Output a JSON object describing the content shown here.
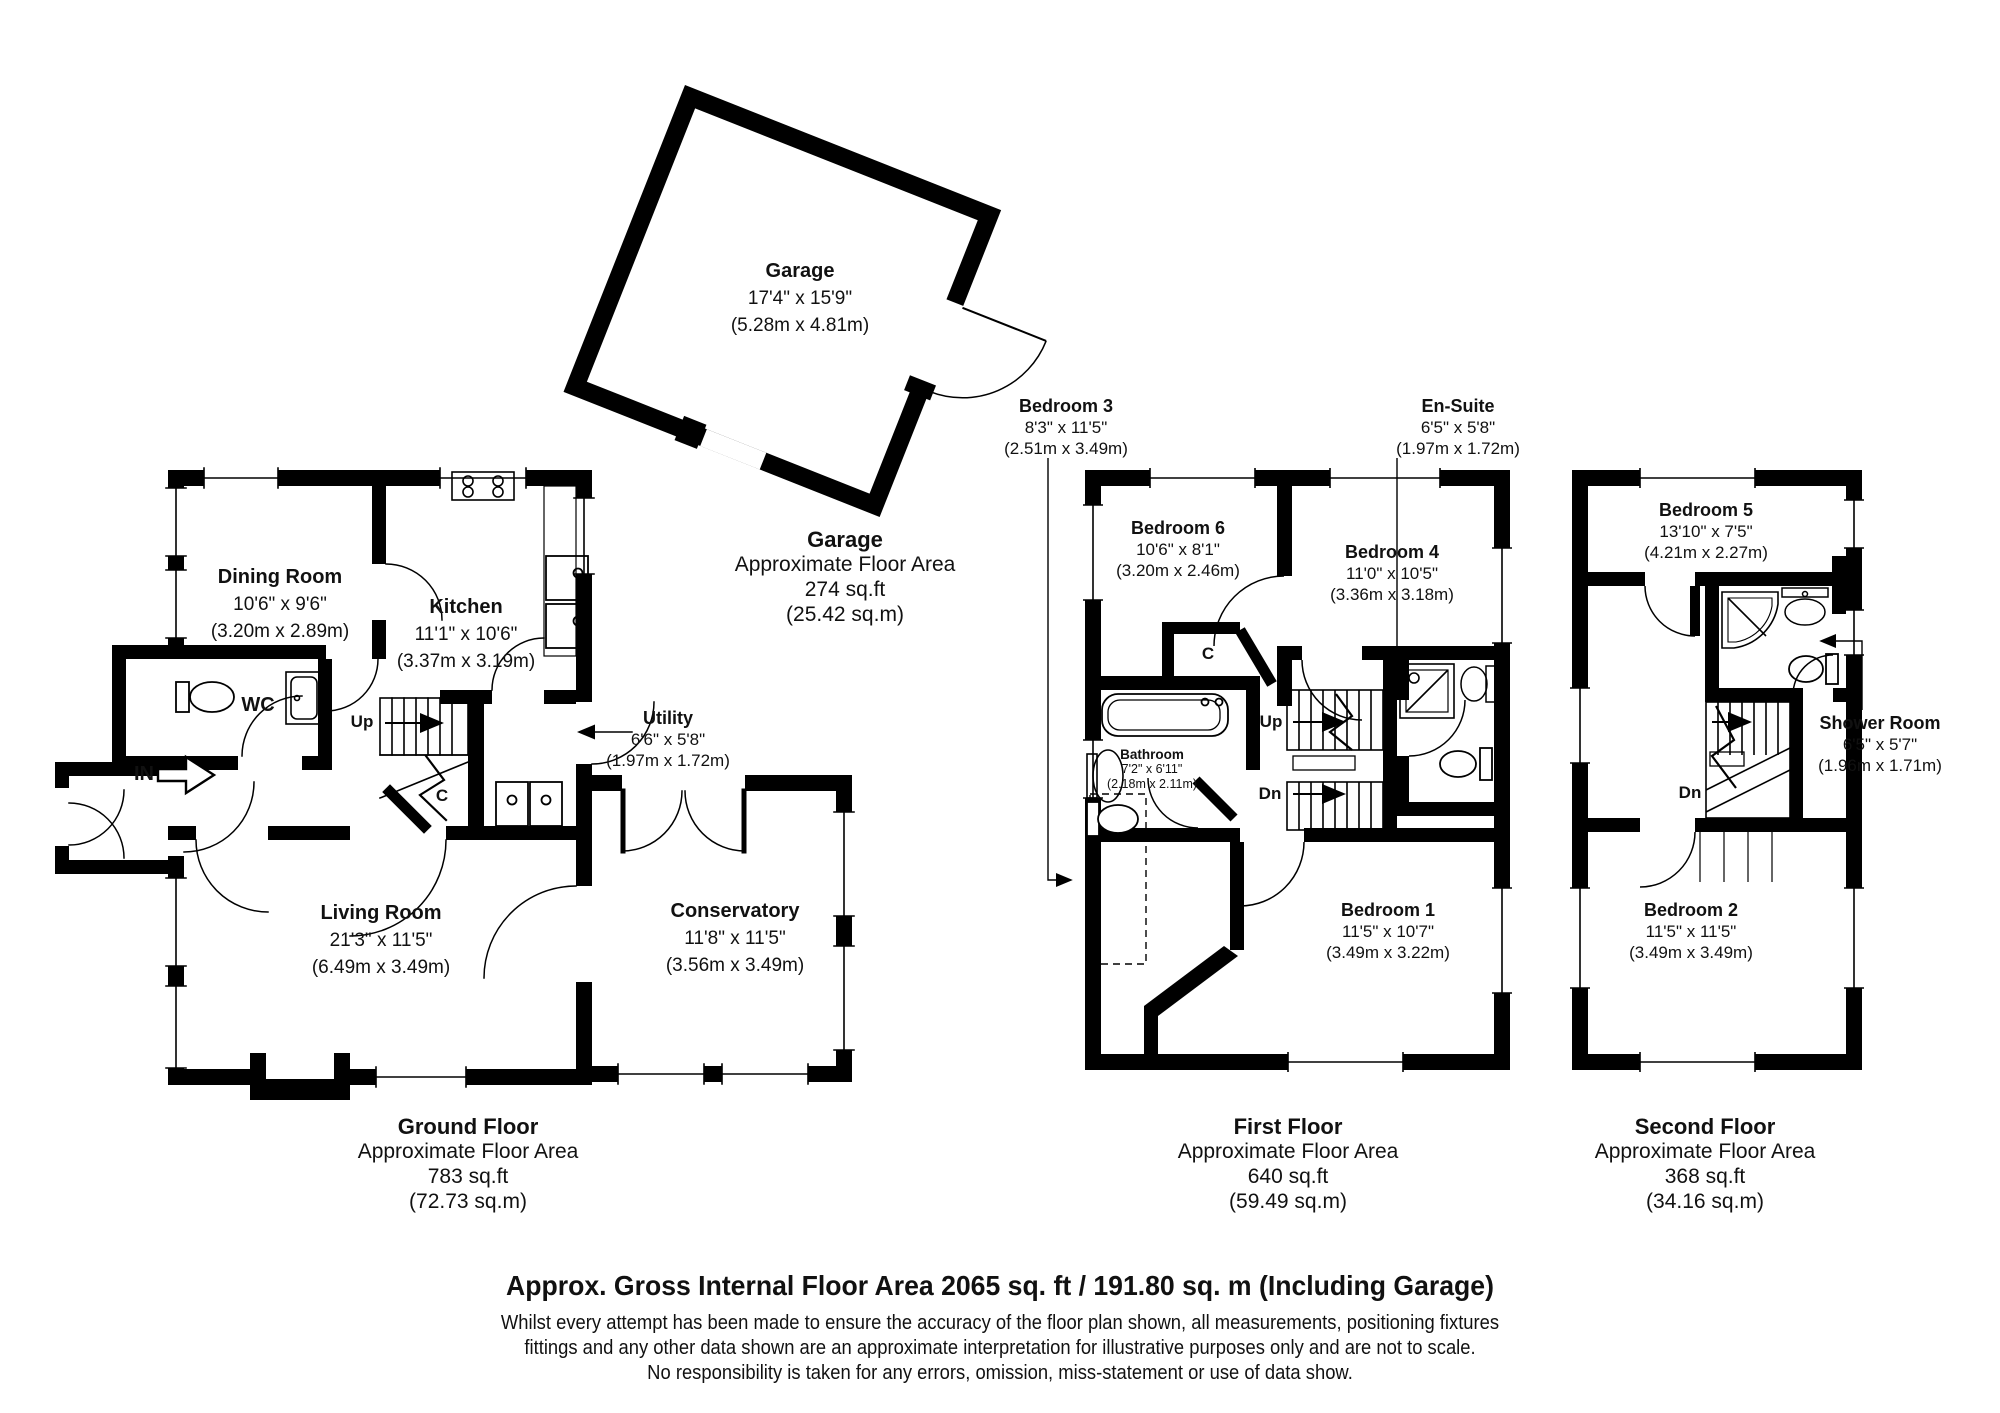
{
  "garage": {
    "room_label": {
      "name": "Garage",
      "dims_ft": "17'4\" x 15'9\"",
      "dims_m": "(5.28m x 4.81m)"
    },
    "summary": {
      "title": "Garage",
      "subtitle": "Approximate Floor Area",
      "area_ft": "274 sq.ft",
      "area_m": "(25.42 sq.m)"
    }
  },
  "ground_floor": {
    "rooms": {
      "dining_room": {
        "name": "Dining Room",
        "dims_ft": "10'6\" x 9'6\"",
        "dims_m": "(3.20m x 2.89m)"
      },
      "kitchen": {
        "name": "Kitchen",
        "dims_ft": "11'1\" x 10'6\"",
        "dims_m": "(3.37m x 3.19m)"
      },
      "utility": {
        "name": "Utility",
        "dims_ft": "6'6\" x 5'8\"",
        "dims_m": "(1.97m x 1.72m)"
      },
      "living_room": {
        "name": "Living Room",
        "dims_ft": "21'3\" x 11'5\"",
        "dims_m": "(6.49m x 3.49m)"
      },
      "conservatory": {
        "name": "Conservatory",
        "dims_ft": "11'8\" x 11'5\"",
        "dims_m": "(3.56m x 3.49m)"
      },
      "wc": {
        "name": "WC"
      }
    },
    "markers": {
      "up": "Up",
      "closet": "C",
      "entrance": "IN"
    },
    "summary": {
      "title": "Ground Floor",
      "subtitle": "Approximate Floor Area",
      "area_ft": "783 sq.ft",
      "area_m": "(72.73 sq.m)"
    }
  },
  "first_floor": {
    "rooms": {
      "bedroom_3": {
        "name": "Bedroom 3",
        "dims_ft": "8'3\" x 11'5\"",
        "dims_m": "(2.51m x 3.49m)"
      },
      "bedroom_6": {
        "name": "Bedroom 6",
        "dims_ft": "10'6\" x 8'1\"",
        "dims_m": "(3.20m x 2.46m)"
      },
      "bedroom_4": {
        "name": "Bedroom 4",
        "dims_ft": "11'0\" x 10'5\"",
        "dims_m": "(3.36m x 3.18m)"
      },
      "en_suite": {
        "name": "En-Suite",
        "dims_ft": "6'5\" x 5'8\"",
        "dims_m": "(1.97m x 1.72m)"
      },
      "bathroom": {
        "name": "Bathroom",
        "dims_ft": "7'2\" x 6'11\"",
        "dims_m": "(2.18m x 2.11m)"
      },
      "bedroom_1": {
        "name": "Bedroom 1",
        "dims_ft": "11'5\" x 10'7\"",
        "dims_m": "(3.49m x 3.22m)"
      }
    },
    "markers": {
      "up": "Up",
      "dn": "Dn",
      "closet": "C"
    },
    "summary": {
      "title": "First Floor",
      "subtitle": "Approximate Floor Area",
      "area_ft": "640 sq.ft",
      "area_m": "(59.49 sq.m)"
    }
  },
  "second_floor": {
    "rooms": {
      "bedroom_5": {
        "name": "Bedroom 5",
        "dims_ft": "13'10\" x 7'5\"",
        "dims_m": "(4.21m x 2.27m)"
      },
      "shower_room": {
        "name": "Shower Room",
        "dims_ft": "6'5\" x 5'7\"",
        "dims_m": "(1.96m x 1.71m)"
      },
      "bedroom_2": {
        "name": "Bedroom 2",
        "dims_ft": "11'5\" x 11'5\"",
        "dims_m": "(3.49m x 3.49m)"
      }
    },
    "markers": {
      "dn": "Dn"
    },
    "summary": {
      "title": "Second Floor",
      "subtitle": "Approximate Floor Area",
      "area_ft": "368 sq.ft",
      "area_m": "(34.16 sq.m)"
    }
  },
  "footer": {
    "headline": "Approx. Gross Internal Floor Area 2065 sq. ft / 191.80 sq. m (Including Garage)",
    "disclaimer": [
      "Whilst every attempt has been made to ensure the accuracy of the floor plan shown, all measurements, positioning fixtures",
      "fittings and any other data shown are an approximate interpretation for illustrative purposes only and are not to scale.",
      "No responsibility is taken for any errors, omission, miss-statement or use of data show."
    ]
  },
  "colors": {
    "wall": "#000000",
    "background": "#ffffff"
  }
}
